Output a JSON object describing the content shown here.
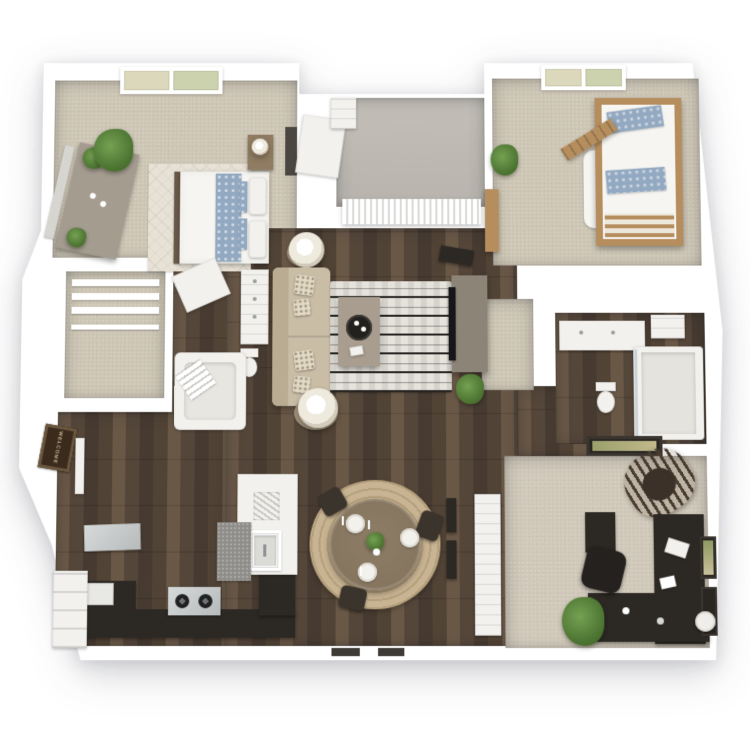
{
  "scene": {
    "title": "3D apartment floor plan render",
    "background": "#ffffff"
  },
  "entry": {
    "welcome_mat_text": "WELCOME"
  },
  "palette": {
    "bg": "#ffffff",
    "wall": "#ffffff",
    "wood_floor": "#55463a",
    "wood_plank_light": "#6a5847",
    "wood_plank_dark": "#473b31",
    "carpet_light": "#cdc5b4",
    "carpet_office": "#cfc7b8",
    "concrete": "#b8b4ad",
    "counter_dark": "#2c2824",
    "cabinet_white": "#f2f1ee",
    "sofa_beige": "#c9bda6",
    "rug_black": "#24231f",
    "rug_white": "#e6e3dc",
    "rug_jute": "#c8b392",
    "table_wood": "#85755f",
    "bunk_wood": "#b68e5e",
    "bedding_white": "#f6f5f1",
    "bedding_blue": "#93a9c1",
    "plant_green": "#49702f",
    "mat_brown": "#3a2b1d",
    "mat_border": "#6b573d",
    "mat_text": "#c7b693",
    "steel": "#b7babb",
    "window_pane_a": "#dcd8bb",
    "window_pane_b": "#ccd2ad"
  },
  "rooms": [
    {
      "id": "master-bedroom",
      "name": "Master Bedroom",
      "floor": "carpet"
    },
    {
      "id": "walk-in-closet",
      "name": "Walk-in Closet",
      "floor": "carpet"
    },
    {
      "id": "master-bathroom",
      "name": "Master Bathroom",
      "floor": "wood"
    },
    {
      "id": "living-room",
      "name": "Living Room",
      "floor": "wood"
    },
    {
      "id": "dining-area",
      "name": "Dining Area",
      "floor": "wood"
    },
    {
      "id": "kitchen",
      "name": "Kitchen",
      "floor": "wood"
    },
    {
      "id": "entry",
      "name": "Entry",
      "floor": "wood"
    },
    {
      "id": "balcony",
      "name": "Balcony",
      "floor": "concrete"
    },
    {
      "id": "bedroom-2",
      "name": "Bedroom 2",
      "floor": "carpet"
    },
    {
      "id": "bathroom-2",
      "name": "Bathroom 2",
      "floor": "wood"
    },
    {
      "id": "office-den",
      "name": "Office / Den",
      "floor": "carpet"
    }
  ],
  "furniture": {
    "master_bedroom": [
      "queen-bed",
      "blue-accent-bedding",
      "trellis-rug",
      "nightstand",
      "table-lamp",
      "dresser",
      "leaning-mirror",
      "potted-plants",
      "window"
    ],
    "walk_in_closet": [
      "shelving",
      "closet-rod"
    ],
    "master_bathroom": [
      "vanity-sink",
      "toilet",
      "garden-tub",
      "towels",
      "door"
    ],
    "living_room": [
      "sofa",
      "throw-pillows",
      "two-table-lamps",
      "side-tables",
      "patterned-rug",
      "coffee-table",
      "serving-tray",
      "media-console",
      "tv",
      "wall-niche",
      "floor-plant",
      "vertical-blinds"
    ],
    "dining_area": [
      "round-dining-table",
      "three-chairs",
      "three-place-settings",
      "centerpiece-plant",
      "round-jute-rug"
    ],
    "kitchen": [
      "l-shaped-dark-counter",
      "gas-range",
      "range-hood",
      "refrigerator",
      "peninsula-counter",
      "farmhouse-sink",
      "dish-rack",
      "runner-rug"
    ],
    "entry": [
      "welcome-mat",
      "entry-door",
      "pantry-shelves"
    ],
    "balcony": [
      "concrete-deck",
      "sliding-door-blinds"
    ],
    "laundry_closet": [
      "open-door",
      "water-heater",
      "shelf-niche"
    ],
    "bedroom_2": [
      "bunk-bed",
      "ladder",
      "blue-pillows",
      "guard-rails",
      "plant",
      "wall-shelf",
      "window"
    ],
    "bathroom_2": [
      "vanity",
      "toilet",
      "tub-shower",
      "linen-shelf"
    ],
    "office_den": [
      "rocking-chair",
      "l-shaped-desk",
      "office-chair",
      "file-cabinet",
      "laptop",
      "papers",
      "floor-plant",
      "framed-art-prints",
      "closet-doors",
      "round-stool"
    ]
  }
}
